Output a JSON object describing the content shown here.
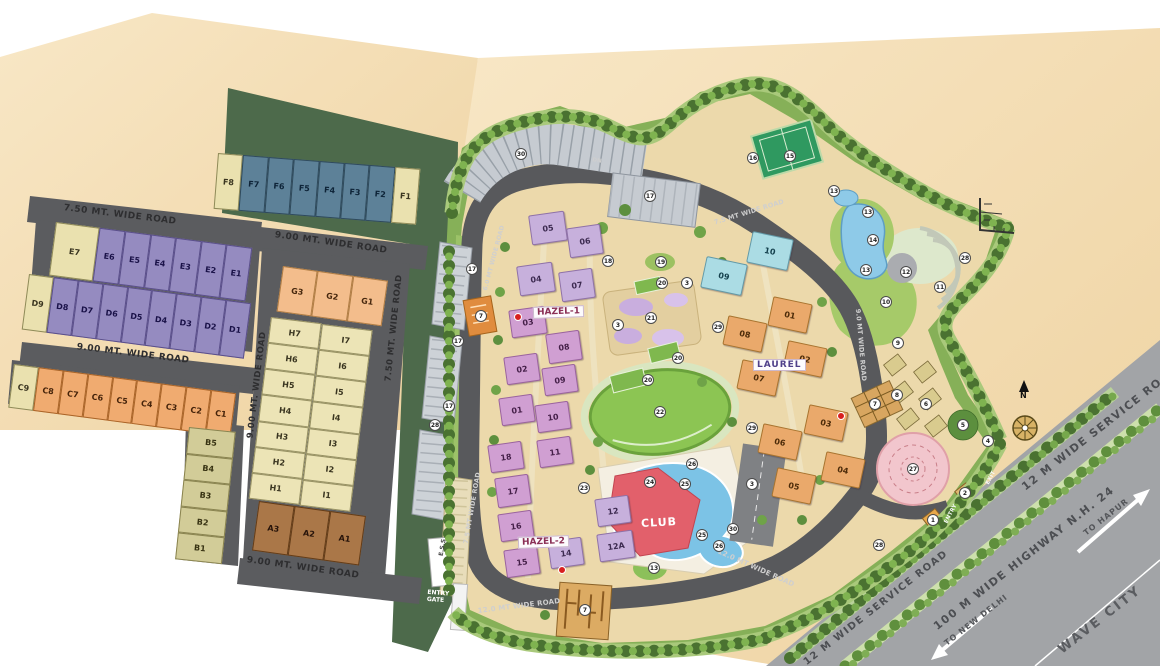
{
  "colors": {
    "ground_beige": "#f4dcab",
    "road_gray": "#5b5c5f",
    "highway_gray": "#a2a4a7",
    "green_dark": "#4d6a4b",
    "green_light": "#a9cc6d",
    "lawn_green": "#8cc553",
    "hazel_pink": "#d09fd2",
    "hazel_lilac": "#c7b0dc",
    "laurel_orange": "#eaa96b",
    "tower_cyan": "#abdce4",
    "club_red": "#e2606b",
    "pool_blue": "#7cc3e6",
    "plot_purple": "#958bc0",
    "plot_slate": "#5d8198",
    "plot_orange": "#f0ab70",
    "plot_cream": "#eae1af",
    "plot_brown": "#aa7748",
    "mandala_pink": "#f2c6cd"
  },
  "plots": {
    "groups": [
      {
        "id": "f-row",
        "labels": [
          "F8",
          "F7",
          "F6",
          "F5",
          "F4",
          "F3",
          "F2",
          "F1"
        ],
        "style": "slate",
        "overrides": {
          "0": "cream",
          "7": "cream"
        }
      },
      {
        "id": "e-row",
        "labels": [
          "E7",
          "E6",
          "E5",
          "E4",
          "E3",
          "E2",
          "E1"
        ],
        "style": "purple",
        "overrides": {
          "0": "cream wide"
        }
      },
      {
        "id": "d-row",
        "labels": [
          "D9",
          "D8",
          "D7",
          "D6",
          "D5",
          "D4",
          "D3",
          "D2",
          "D1"
        ],
        "style": "purple",
        "overrides": {
          "0": "cream"
        }
      },
      {
        "id": "c-row",
        "labels": [
          "C9",
          "C8",
          "C7",
          "C6",
          "C5",
          "C4",
          "C3",
          "C2",
          "C1"
        ],
        "style": "orange",
        "overrides": {
          "0": "cream"
        }
      },
      {
        "id": "b-col",
        "labels": [
          "B5",
          "B4",
          "B3",
          "B2",
          "B1"
        ],
        "style": "khaki"
      },
      {
        "id": "g-row",
        "labels": [
          "G3",
          "G2",
          "G1"
        ],
        "style": "peach"
      },
      {
        "id": "h-col",
        "labels": [
          "H7",
          "H6",
          "H5",
          "H4",
          "H3",
          "H2",
          "H1"
        ],
        "style": "cream2"
      },
      {
        "id": "i-col",
        "labels": [
          "I7",
          "I6",
          "I5",
          "I4",
          "I3",
          "I2",
          "I1"
        ],
        "style": "cream2"
      },
      {
        "id": "a-row",
        "labels": [
          "A3",
          "A2",
          "A1"
        ],
        "style": "brown"
      }
    ]
  },
  "buildings": {
    "hazel1_label": "HAZEL-1",
    "hazel2_label": "HAZEL-2",
    "laurel_label": "LAUREL",
    "club_label": "CLUB",
    "towers": [
      {
        "n": "05",
        "x": 548,
        "y": 228,
        "w": 36,
        "h": 30,
        "c": "hl"
      },
      {
        "n": "06",
        "x": 585,
        "y": 241,
        "w": 34,
        "h": 30,
        "c": "hl"
      },
      {
        "n": "04",
        "x": 536,
        "y": 279,
        "w": 36,
        "h": 30,
        "c": "hl"
      },
      {
        "n": "07",
        "x": 577,
        "y": 285,
        "w": 34,
        "h": 30,
        "c": "hl"
      },
      {
        "n": "03",
        "x": 528,
        "y": 322,
        "w": 36,
        "h": 28,
        "c": "hp"
      },
      {
        "n": "08",
        "x": 564,
        "y": 347,
        "w": 34,
        "h": 30,
        "c": "hp"
      },
      {
        "n": "02",
        "x": 522,
        "y": 369,
        "w": 34,
        "h": 28,
        "c": "hp"
      },
      {
        "n": "09",
        "x": 560,
        "y": 380,
        "w": 34,
        "h": 28,
        "c": "hp"
      },
      {
        "n": "01",
        "x": 517,
        "y": 410,
        "w": 34,
        "h": 28,
        "c": "hp"
      },
      {
        "n": "10",
        "x": 553,
        "y": 417,
        "w": 34,
        "h": 28,
        "c": "hp"
      },
      {
        "n": "18",
        "x": 506,
        "y": 457,
        "w": 34,
        "h": 28,
        "c": "hp"
      },
      {
        "n": "11",
        "x": 555,
        "y": 452,
        "w": 34,
        "h": 28,
        "c": "hp"
      },
      {
        "n": "17",
        "x": 513,
        "y": 491,
        "w": 34,
        "h": 30,
        "c": "hp"
      },
      {
        "n": "16",
        "x": 516,
        "y": 526,
        "w": 34,
        "h": 28,
        "c": "hp"
      },
      {
        "n": "15",
        "x": 522,
        "y": 562,
        "w": 34,
        "h": 28,
        "c": "hp"
      },
      {
        "n": "14",
        "x": 566,
        "y": 553,
        "w": 34,
        "h": 28,
        "c": "hl"
      },
      {
        "n": "12",
        "x": 613,
        "y": 511,
        "w": 34,
        "h": 28,
        "c": "hl"
      },
      {
        "n": "12A",
        "x": 616,
        "y": 546,
        "w": 36,
        "h": 28,
        "c": "hl"
      },
      {
        "n": "10",
        "x": 770,
        "y": 251,
        "w": 42,
        "h": 32,
        "c": "cy"
      },
      {
        "n": "09",
        "x": 724,
        "y": 276,
        "w": 42,
        "h": 32,
        "c": "cy"
      },
      {
        "n": "01",
        "x": 790,
        "y": 315,
        "w": 40,
        "h": 30,
        "c": "lr"
      },
      {
        "n": "08",
        "x": 745,
        "y": 334,
        "w": 40,
        "h": 30,
        "c": "lr"
      },
      {
        "n": "02",
        "x": 805,
        "y": 359,
        "w": 40,
        "h": 30,
        "c": "lr"
      },
      {
        "n": "07",
        "x": 759,
        "y": 378,
        "w": 40,
        "h": 30,
        "c": "lr"
      },
      {
        "n": "03",
        "x": 826,
        "y": 423,
        "w": 40,
        "h": 30,
        "c": "lr"
      },
      {
        "n": "06",
        "x": 780,
        "y": 442,
        "w": 40,
        "h": 30,
        "c": "lr"
      },
      {
        "n": "04",
        "x": 843,
        "y": 470,
        "w": 40,
        "h": 30,
        "c": "lr"
      },
      {
        "n": "05",
        "x": 794,
        "y": 486,
        "w": 40,
        "h": 30,
        "c": "lr"
      }
    ]
  },
  "markers": [
    {
      "n": "30",
      "x": 521,
      "y": 154
    },
    {
      "n": "17",
      "x": 650,
      "y": 196
    },
    {
      "n": "16",
      "x": 753,
      "y": 158
    },
    {
      "n": "15",
      "x": 790,
      "y": 156
    },
    {
      "n": "13",
      "x": 834,
      "y": 191
    },
    {
      "n": "13",
      "x": 868,
      "y": 212
    },
    {
      "n": "14",
      "x": 873,
      "y": 240
    },
    {
      "n": "13",
      "x": 866,
      "y": 270
    },
    {
      "n": "28",
      "x": 965,
      "y": 258
    },
    {
      "n": "12",
      "x": 906,
      "y": 272
    },
    {
      "n": "11",
      "x": 940,
      "y": 287
    },
    {
      "n": "10",
      "x": 886,
      "y": 302
    },
    {
      "n": "9",
      "x": 898,
      "y": 343
    },
    {
      "n": "17",
      "x": 472,
      "y": 269
    },
    {
      "n": "18",
      "x": 608,
      "y": 261
    },
    {
      "n": "19",
      "x": 661,
      "y": 262
    },
    {
      "n": "20",
      "x": 662,
      "y": 283
    },
    {
      "n": "3",
      "x": 687,
      "y": 283
    },
    {
      "n": "21",
      "x": 651,
      "y": 318
    },
    {
      "n": "3",
      "x": 618,
      "y": 325
    },
    {
      "n": "29",
      "x": 718,
      "y": 327
    },
    {
      "n": "17",
      "x": 458,
      "y": 341
    },
    {
      "n": "20",
      "x": 678,
      "y": 358
    },
    {
      "n": "20",
      "x": 648,
      "y": 380
    },
    {
      "n": "7",
      "x": 481,
      "y": 316
    },
    {
      "n": "17",
      "x": 449,
      "y": 406
    },
    {
      "n": "28",
      "x": 435,
      "y": 425
    },
    {
      "n": "22",
      "x": 660,
      "y": 412
    },
    {
      "n": "29",
      "x": 752,
      "y": 428
    },
    {
      "n": "8",
      "x": 897,
      "y": 395
    },
    {
      "n": "6",
      "x": 926,
      "y": 404
    },
    {
      "n": "7",
      "x": 875,
      "y": 404
    },
    {
      "n": "5",
      "x": 963,
      "y": 425
    },
    {
      "n": "4",
      "x": 988,
      "y": 441
    },
    {
      "n": "26",
      "x": 692,
      "y": 464
    },
    {
      "n": "27",
      "x": 913,
      "y": 469
    },
    {
      "n": "24",
      "x": 650,
      "y": 482
    },
    {
      "n": "25",
      "x": 685,
      "y": 484
    },
    {
      "n": "3",
      "x": 752,
      "y": 484
    },
    {
      "n": "23",
      "x": 584,
      "y": 488
    },
    {
      "n": "2",
      "x": 965,
      "y": 493
    },
    {
      "n": "1",
      "x": 933,
      "y": 520
    },
    {
      "n": "30",
      "x": 733,
      "y": 529
    },
    {
      "n": "25",
      "x": 702,
      "y": 535
    },
    {
      "n": "26",
      "x": 719,
      "y": 546
    },
    {
      "n": "28",
      "x": 879,
      "y": 545
    },
    {
      "n": "13",
      "x": 654,
      "y": 568
    },
    {
      "n": "7",
      "x": 585,
      "y": 610
    }
  ],
  "road_labels": [
    {
      "text": "7.50 MT. WIDE ROAD",
      "x": 120,
      "y": 215,
      "rot": 7,
      "theme": "dark",
      "fs": 9
    },
    {
      "text": "9.00 MT. WIDE ROAD",
      "x": 331,
      "y": 243,
      "rot": 8,
      "theme": "dark",
      "fs": 9
    },
    {
      "text": "9.00 MT. WIDE ROAD",
      "x": 133,
      "y": 354,
      "rot": 7,
      "theme": "dark",
      "fs": 9
    },
    {
      "text": "9.00 MT. WIDE ROAD",
      "x": 257,
      "y": 385,
      "rot": -83,
      "theme": "dark",
      "fs": 8.5
    },
    {
      "text": "7.50 MT. WIDE ROAD",
      "x": 394,
      "y": 328,
      "rot": -84,
      "theme": "dark",
      "fs": 8.5
    },
    {
      "text": "9.00 MT. WIDE ROAD",
      "x": 303,
      "y": 568,
      "rot": 8,
      "theme": "dark",
      "fs": 9
    },
    {
      "text": "6.0 MT WIDE ROAD",
      "x": 494,
      "y": 258,
      "rot": -75,
      "theme": "light",
      "fs": 6
    },
    {
      "text": "7.5 MT WIDE ROAD",
      "x": 749,
      "y": 212,
      "rot": -17,
      "theme": "light",
      "fs": 6.5
    },
    {
      "text": "7.5 MT WIDE ROAD",
      "x": 472,
      "y": 508,
      "rot": -80,
      "theme": "light",
      "fs": 6.5
    },
    {
      "text": "9.0 MT WIDE ROAD",
      "x": 861,
      "y": 345,
      "rot": 85,
      "theme": "light",
      "fs": 6.5
    },
    {
      "text": "12.0 MT WIDE ROAD",
      "x": 519,
      "y": 606,
      "rot": -7,
      "theme": "light",
      "fs": 7
    },
    {
      "text": "12.0 MT WIDE ROAD",
      "x": 756,
      "y": 568,
      "rot": 24,
      "theme": "light",
      "fs": 7
    },
    {
      "text": "12 M WIDE SERVICE ROAD",
      "x": 1100,
      "y": 428,
      "rot": -38,
      "theme": "hwy",
      "fs": 11
    },
    {
      "text": "12 M WIDE SERVICE ROAD",
      "x": 876,
      "y": 608,
      "rot": -38,
      "theme": "hwy",
      "fs": 10
    },
    {
      "text": "100 M WIDE HIGHWAY N.H. 24",
      "x": 1024,
      "y": 558,
      "rot": -38,
      "theme": "hwy",
      "fs": 11
    },
    {
      "text": "TO HAPUR",
      "x": 1106,
      "y": 517,
      "rot": -38,
      "theme": "hwy-sm",
      "fs": 8
    },
    {
      "text": "TO NEW DELHI",
      "x": 976,
      "y": 620,
      "rot": -38,
      "theme": "hwy-sm",
      "fs": 8
    },
    {
      "text": "WAVE CITY",
      "x": 1100,
      "y": 620,
      "rot": -38,
      "theme": "hwy-big",
      "fs": 13
    },
    {
      "text": "DN",
      "x": 597,
      "y": 161,
      "rot": 10,
      "theme": "light",
      "fs": 5.5
    },
    {
      "text": "ENTRY",
      "x": 951,
      "y": 514,
      "rot": -62,
      "theme": "white",
      "fs": 5.5
    },
    {
      "text": "EXIT",
      "x": 991,
      "y": 478,
      "rot": -62,
      "theme": "white",
      "fs": 5.5
    }
  ],
  "labels": {
    "entry_gate": "ENTRY GATE",
    "ess": "E.S.S",
    "north": "N"
  },
  "red_dots": [
    {
      "x": 518,
      "y": 317
    },
    {
      "x": 562,
      "y": 570
    },
    {
      "x": 841,
      "y": 416
    }
  ]
}
